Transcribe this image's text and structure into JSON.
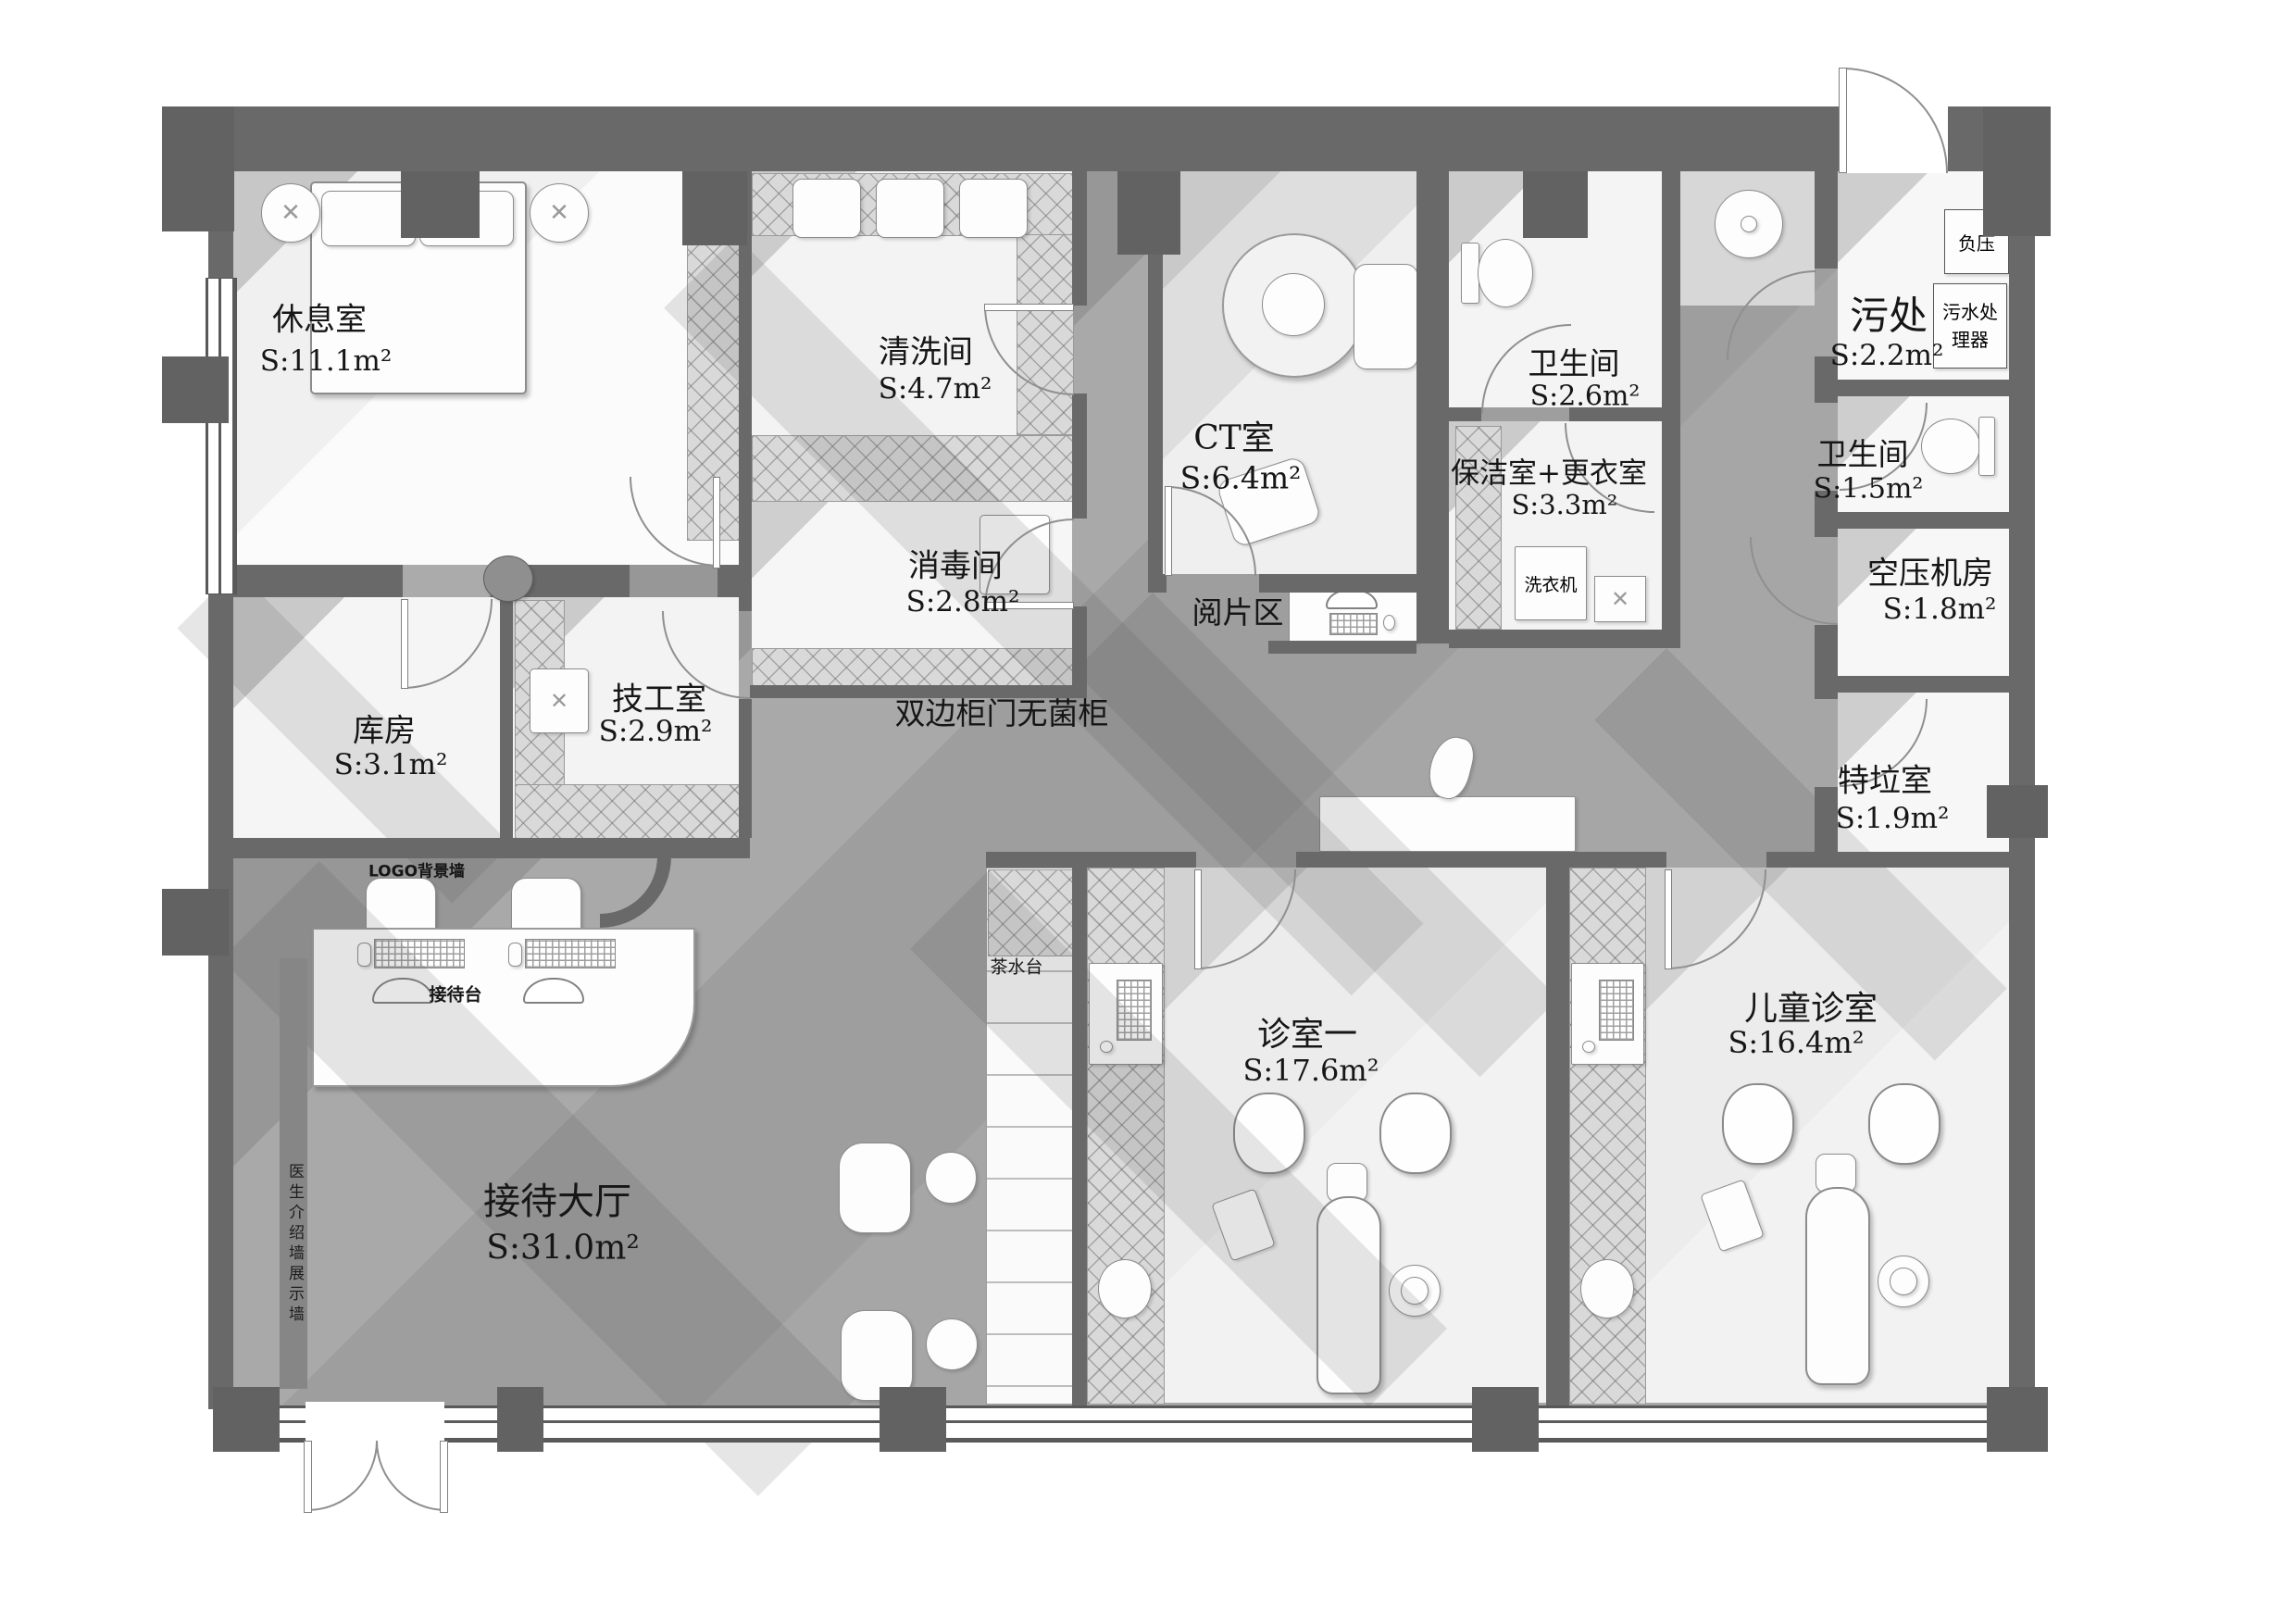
{
  "plan": {
    "type": "architectural floor plan",
    "subject": "dental clinic furniture layout plan"
  },
  "colors": {
    "wall": "#696969",
    "corridor_floor": "#a6a6a6",
    "room_floor_light": "#f2f2f2",
    "treatment_floor": "#ededed",
    "furniture": "#fdfdfd",
    "shadow": "#4e4e4e"
  },
  "rooms": [
    {
      "name": "休息室",
      "area": "S:11.1m²"
    },
    {
      "name": "清洗间",
      "area": "S:4.7m²"
    },
    {
      "name": "消毒间",
      "area": "S:2.8m²"
    },
    {
      "name": "CT室",
      "area": "S:6.4m²"
    },
    {
      "name": "卫生间",
      "area": "S:2.6m²"
    },
    {
      "name": "污处",
      "area": "S:2.2m²"
    },
    {
      "name": "卫生间",
      "area": "S:1.5m²"
    },
    {
      "name": "保洁室+更衣室",
      "area": "S:3.3m²"
    },
    {
      "name": "空压机房",
      "area": "S:1.8m²"
    },
    {
      "name": "特垃室",
      "area": "S:1.9m²"
    },
    {
      "name": "库房",
      "area": "S:3.1m²"
    },
    {
      "name": "技工室",
      "area": "S:2.9m²"
    },
    {
      "name": "接待大厅",
      "area": "S:31.0m²"
    },
    {
      "name": "诊室一",
      "area": "S:17.6m²"
    },
    {
      "name": "儿童诊室",
      "area": "S:16.4m²"
    }
  ],
  "labels": {
    "sterile_cabinet": "双边柜门无菌柜",
    "film_reading": "阅片区",
    "tea_station": "茶水台",
    "reception_desk": "接待台",
    "logo_wall": "LOGO背景墙",
    "doctor_wall": "医生介绍墙展示墙",
    "washing_machine": "洗衣机",
    "negative_pressure": "负压",
    "sewage_treater": "污水处理器"
  },
  "icons": {
    "cross": "✕"
  }
}
